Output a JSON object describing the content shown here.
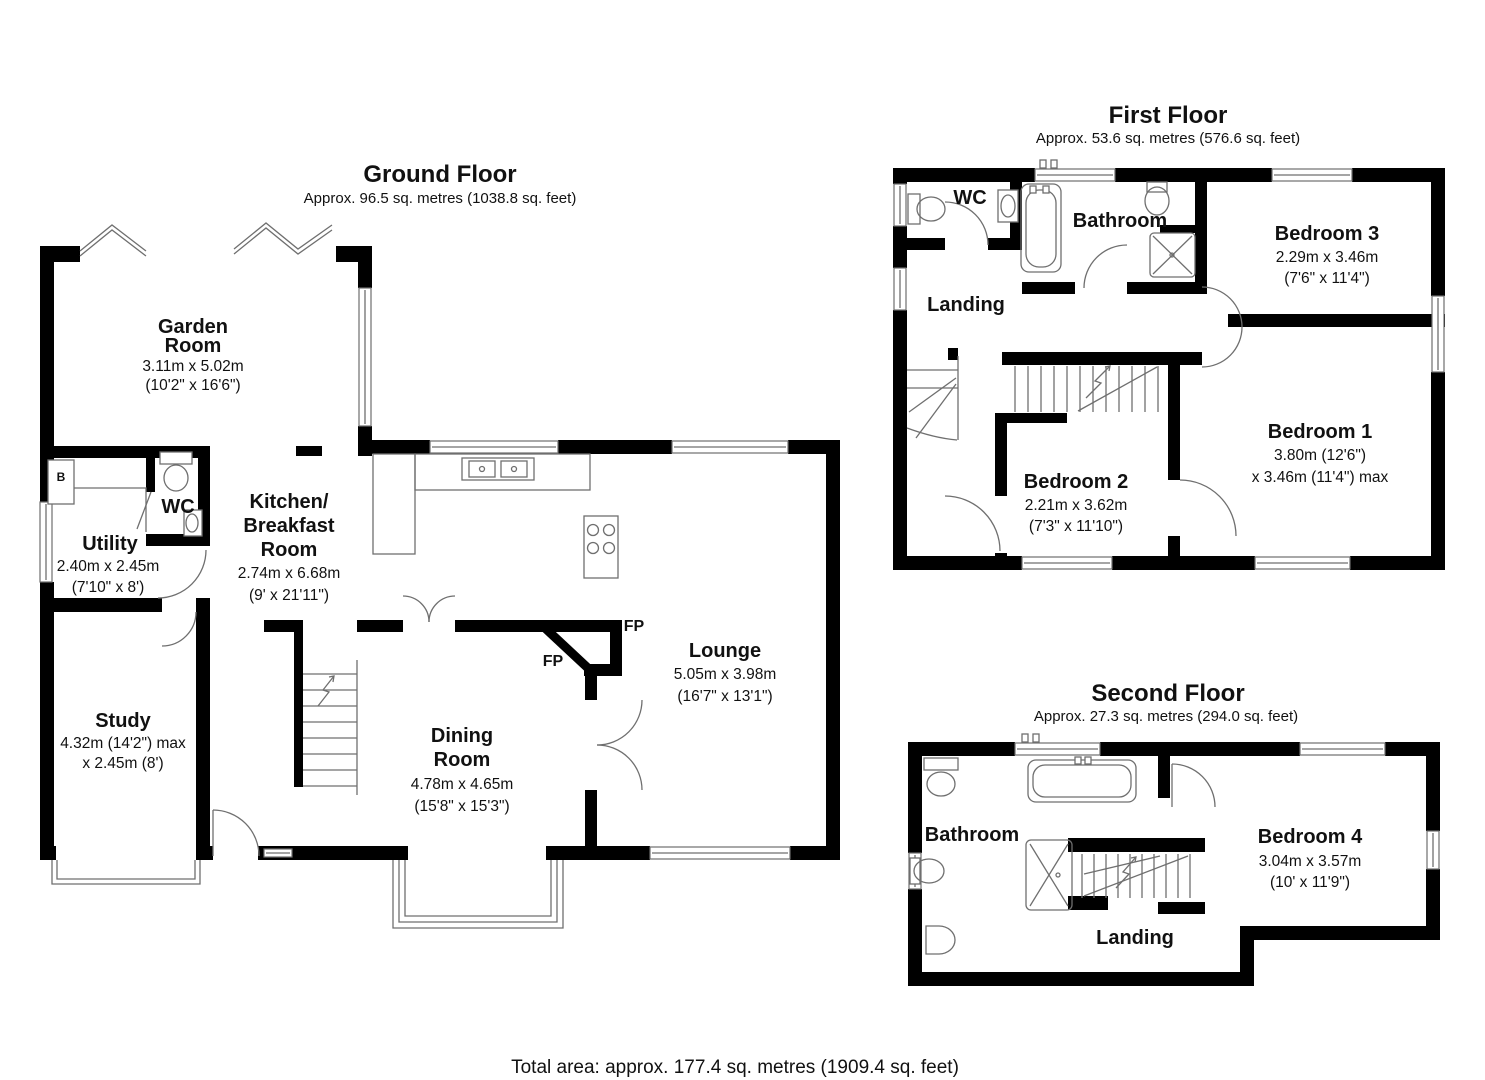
{
  "floors": {
    "ground": {
      "title": "Ground Floor",
      "subtitle": "Approx. 96.5 sq. metres (1038.8 sq. feet)",
      "rooms": {
        "garden_room": {
          "name1": "Garden",
          "name2": "Room",
          "dim_m": "3.11m x 5.02m",
          "dim_ft": "(10'2\" x 16'6\")"
        },
        "wc": {
          "name1": "WC"
        },
        "utility": {
          "name1": "Utility",
          "dim_m": "2.40m x 2.45m",
          "dim_ft": "(7'10\" x 8')"
        },
        "study": {
          "name1": "Study",
          "dim_m": "4.32m (14'2\") max",
          "dim_ft": "x 2.45m (8')"
        },
        "kitchen": {
          "name1": "Kitchen/",
          "name2": "Breakfast",
          "name3": "Room",
          "dim_m": "2.74m x 6.68m",
          "dim_ft": "(9' x 21'11\")"
        },
        "dining": {
          "name1": "Dining",
          "name2": "Room",
          "dim_m": "4.78m x 4.65m",
          "dim_ft": "(15'8\" x 15'3\")"
        },
        "lounge": {
          "name1": "Lounge",
          "dim_m": "5.05m x 3.98m",
          "dim_ft": "(16'7\" x 13'1\")"
        }
      },
      "labels": {
        "fp_upper": "FP",
        "fp_lower": "FP",
        "boiler": "B"
      }
    },
    "first": {
      "title": "First Floor",
      "subtitle": "Approx. 53.6 sq. metres (576.6 sq. feet)",
      "rooms": {
        "wc": {
          "name1": "WC"
        },
        "bathroom": {
          "name1": "Bathroom"
        },
        "landing": {
          "name1": "Landing"
        },
        "bedroom3": {
          "name1": "Bedroom 3",
          "dim_m": "2.29m x 3.46m",
          "dim_ft": "(7'6\" x 11'4\")"
        },
        "bedroom2": {
          "name1": "Bedroom 2",
          "dim_m": "2.21m x 3.62m",
          "dim_ft": "(7'3\" x 11'10\")"
        },
        "bedroom1": {
          "name1": "Bedroom 1",
          "dim_m": "3.80m (12'6\")",
          "dim_ft": "x 3.46m (11'4\") max"
        }
      }
    },
    "second": {
      "title": "Second Floor",
      "subtitle": "Approx. 27.3 sq. metres (294.0 sq. feet)",
      "rooms": {
        "bathroom": {
          "name1": "Bathroom"
        },
        "landing": {
          "name1": "Landing"
        },
        "bedroom4": {
          "name1": "Bedroom 4",
          "dim_m": "3.04m x 3.57m",
          "dim_ft": "(10' x 11'9\")"
        }
      }
    }
  },
  "footer": {
    "total": "Total area: approx. 177.4 sq. metres (1909.4 sq. feet)"
  },
  "colors": {
    "wall": "#000000",
    "detail": "#6f6f6f",
    "text": "#111111",
    "background": "#ffffff"
  }
}
